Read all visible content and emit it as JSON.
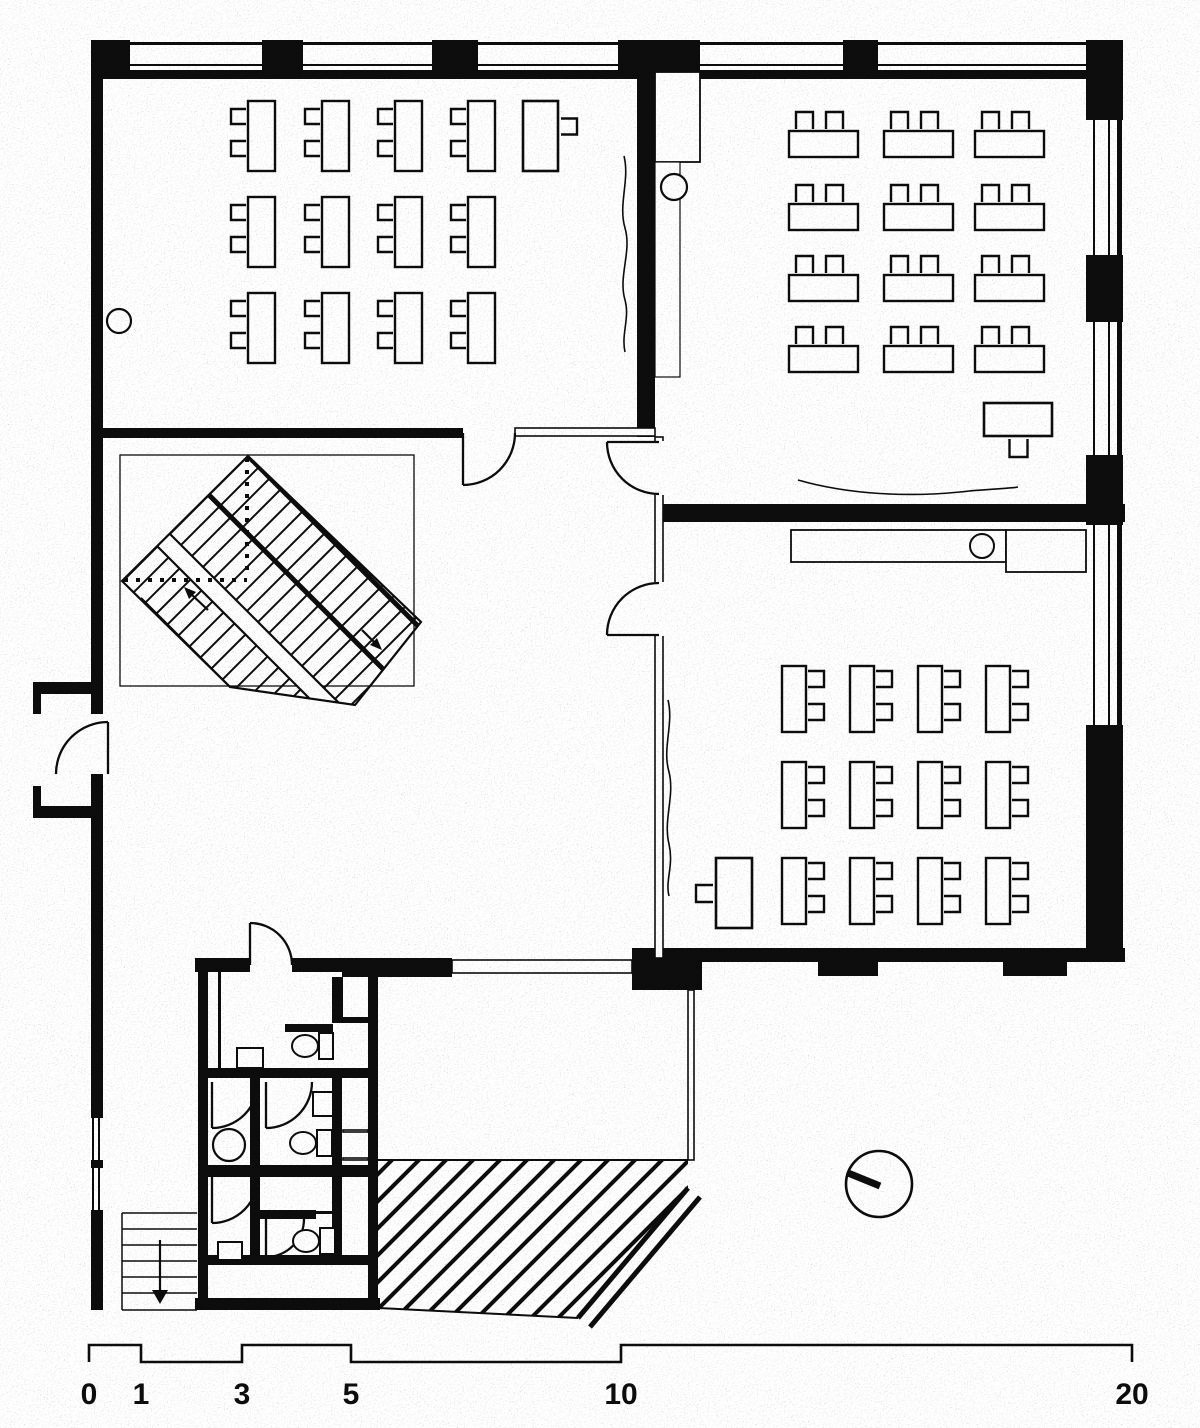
{
  "document": {
    "kind": "scanned architectural floor plan",
    "content": "school ground floor with three classrooms, central hall with diagonal stair, toilet block, entrance ramp",
    "ink_color": "#0d0d0d",
    "paper_color": "#ffffff"
  },
  "scale_bar": {
    "labels": [
      "0",
      "1",
      "3",
      "5",
      "10",
      "20"
    ],
    "tick_x": [
      89,
      141,
      242,
      351,
      621,
      1132
    ],
    "bar_high_y": 1345,
    "bar_low_y": 1362,
    "label_y": 1404
  },
  "classrooms": {
    "top_left": {
      "student_desks": 12,
      "desk": {
        "w": 27,
        "h": 70
      },
      "cols": [
        248,
        322,
        395,
        468
      ],
      "rows": [
        101,
        197,
        293
      ],
      "chair": {
        "size": 15,
        "side": "left",
        "offsets": [
          8,
          40
        ]
      },
      "teacher": {
        "x": 523,
        "y": 101,
        "w": 35,
        "h": 70,
        "chair_side": "right"
      }
    },
    "top_right": {
      "student_desks": 12,
      "desk": {
        "w": 69,
        "h": 26
      },
      "cols": [
        789,
        884,
        975
      ],
      "rows": [
        131,
        204,
        275,
        346
      ],
      "chair": {
        "size": 17,
        "side": "top",
        "offsets": [
          7,
          37
        ]
      },
      "teacher": {
        "x": 984,
        "y": 403,
        "w": 68,
        "h": 33,
        "chair_side": "bottom"
      }
    },
    "mid_right": {
      "student_desks": 12,
      "desk": {
        "w": 24,
        "h": 66
      },
      "cols": [
        782,
        850,
        918,
        986
      ],
      "rows": [
        666,
        762,
        858
      ],
      "chair": {
        "size": 16,
        "side": "right",
        "offsets": [
          5,
          38
        ]
      },
      "teacher": {
        "x": 716,
        "y": 858,
        "w": 36,
        "h": 70,
        "chair_side": "left"
      }
    }
  },
  "fixtures": {
    "wc_toilets": [
      {
        "cistern": [
          319,
          1033,
          14,
          26
        ],
        "bowl": [
          305,
          1046,
          13,
          11
        ]
      },
      {
        "cistern": [
          317,
          1130,
          15,
          26
        ],
        "bowl": [
          303,
          1143,
          13,
          11
        ]
      },
      {
        "cistern": [
          320,
          1228,
          15,
          26
        ],
        "bowl": [
          306,
          1241,
          13,
          11
        ]
      }
    ],
    "sinks_rect": [
      [
        237,
        1048,
        26,
        20
      ],
      [
        313,
        1092,
        20,
        24
      ],
      [
        218,
        1242,
        24,
        18
      ]
    ],
    "sinks_round": [
      {
        "cx": 229,
        "cy": 1145,
        "r": 16
      }
    ],
    "counter": {
      "rects": [
        [
          791,
          530,
          215,
          32
        ],
        [
          1006,
          530,
          80,
          42
        ]
      ],
      "sink": {
        "cx": 982,
        "cy": 546,
        "r": 12
      }
    },
    "cabinet": {
      "rect": [
        655,
        72,
        45,
        90
      ],
      "circle": {
        "cx": 674,
        "cy": 187,
        "r": 13
      }
    },
    "columns": [
      {
        "cx": 119,
        "cy": 321,
        "r": 12
      }
    ],
    "clock": {
      "cx": 879,
      "cy": 1184,
      "r": 33
    }
  },
  "stair": {
    "flight_direction": "diagonal-45",
    "walkline_arrows": [
      "up",
      "down"
    ]
  }
}
